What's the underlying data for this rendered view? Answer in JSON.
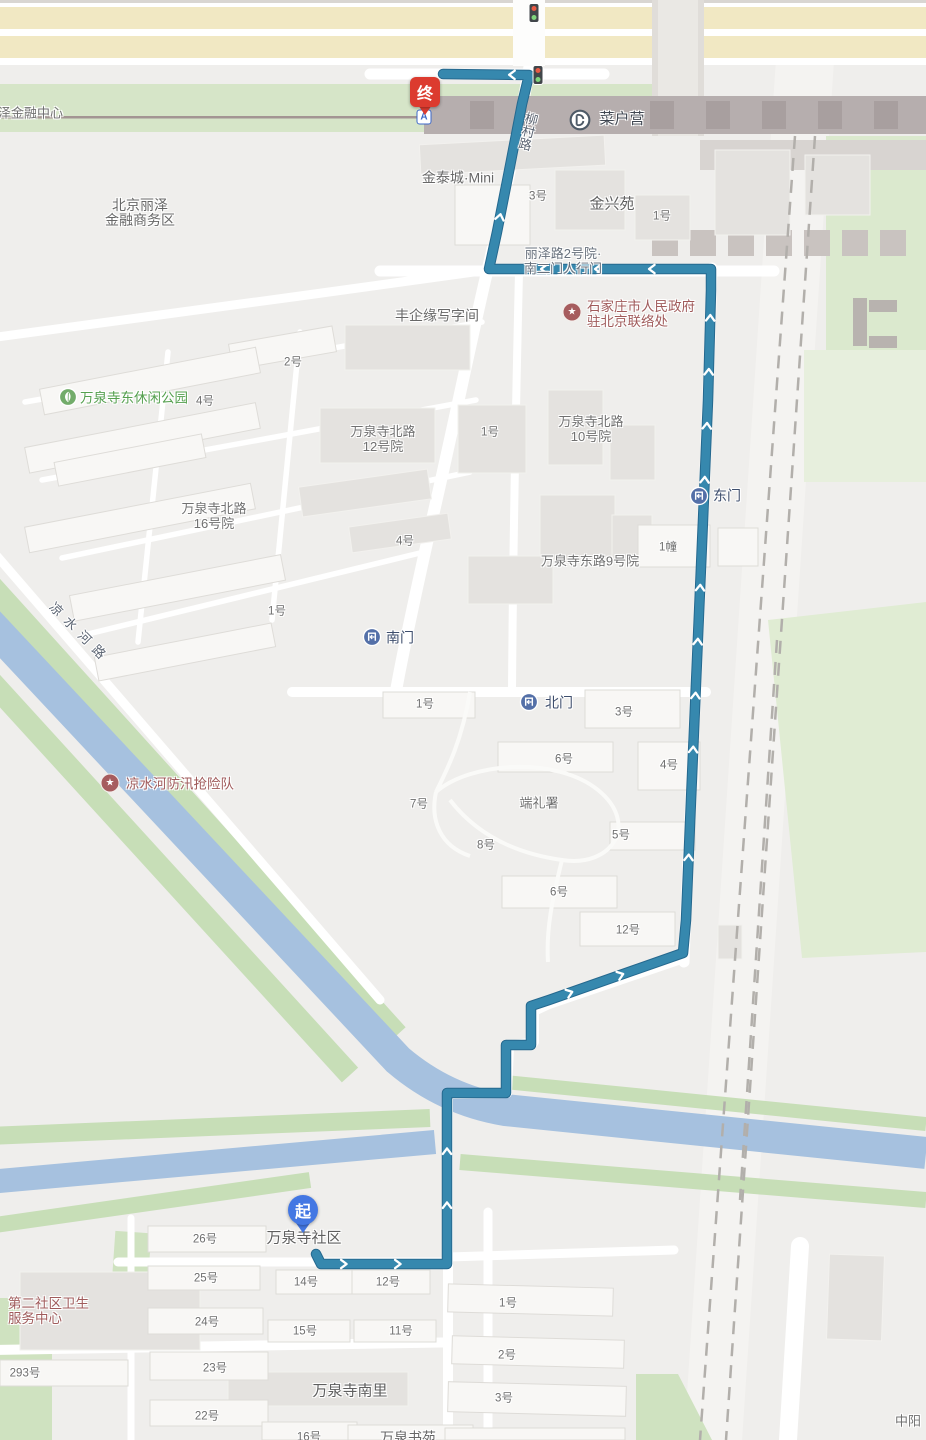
{
  "map": {
    "background": "#efeeec",
    "route": {
      "color": "#3688ae",
      "casing": "#25688e",
      "arrow_color": "#ffffff",
      "points": [
        [
          316,
          1254
        ],
        [
          321,
          1264
        ],
        [
          447,
          1264
        ],
        [
          447,
          1093
        ],
        [
          506,
          1093
        ],
        [
          506,
          1045
        ],
        [
          531,
          1045
        ],
        [
          531,
          1006
        ],
        [
          549,
          1000
        ],
        [
          683,
          953
        ],
        [
          686,
          920
        ],
        [
          691,
          800
        ],
        [
          697,
          660
        ],
        [
          703,
          520
        ],
        [
          708,
          400
        ],
        [
          711,
          290
        ],
        [
          711,
          269
        ],
        [
          489,
          269
        ],
        [
          497,
          232
        ],
        [
          510,
          166
        ],
        [
          522,
          104
        ],
        [
          529,
          75
        ],
        [
          443,
          74
        ]
      ]
    },
    "pins": {
      "end": {
        "label": "终",
        "color": "#dc3b2f",
        "x": 425,
        "y": 92
      },
      "start": {
        "label": "起",
        "color": "#4377e3",
        "x": 303,
        "y": 1210
      }
    },
    "icons": [
      {
        "type": "traffic-light",
        "x": 538,
        "y": 75
      },
      {
        "type": "traffic-light",
        "x": 534,
        "y": 13
      },
      {
        "type": "metro",
        "x": 580,
        "y": 120
      },
      {
        "type": "exit-a",
        "label": "A",
        "x": 424,
        "y": 117
      },
      {
        "type": "gate",
        "x": 699,
        "y": 496
      },
      {
        "type": "gate",
        "x": 372,
        "y": 637
      },
      {
        "type": "gate",
        "x": 529,
        "y": 702
      },
      {
        "type": "star",
        "x": 572,
        "y": 312
      },
      {
        "type": "star",
        "x": 110,
        "y": 783
      },
      {
        "type": "star",
        "x": -10,
        "y": 1305
      },
      {
        "type": "park",
        "x": 68,
        "y": 397
      }
    ],
    "labels": [
      {
        "t": "丽泽金融中心",
        "x": 24,
        "y": 113,
        "cls": "compound"
      },
      {
        "t": "北京丽泽\n金融商务区",
        "x": 140,
        "y": 213,
        "cls": "place-sm"
      },
      {
        "t": "金泰城·Mini",
        "x": 458,
        "y": 178,
        "cls": "place-sm"
      },
      {
        "t": "3号",
        "x": 538,
        "y": 197,
        "cls": "num"
      },
      {
        "t": "金兴苑",
        "x": 612,
        "y": 204,
        "cls": "place"
      },
      {
        "t": "1号",
        "x": 662,
        "y": 217,
        "cls": "num"
      },
      {
        "t": "丽泽路2号院·\n南二门人行门",
        "x": 563,
        "y": 261,
        "cls": "addr"
      },
      {
        "t": "石家庄市人民政府\n驻北京联络处",
        "x": 587,
        "y": 314,
        "cls": "poi-red",
        "align": "left"
      },
      {
        "t": "丰企缘写字间",
        "x": 437,
        "y": 316,
        "cls": "place-sm"
      },
      {
        "t": "2号",
        "x": 293,
        "y": 363,
        "cls": "num"
      },
      {
        "t": "万泉寺东休闲公园",
        "x": 134,
        "y": 398,
        "cls": "poi-green"
      },
      {
        "t": "4号",
        "x": 205,
        "y": 402,
        "cls": "num"
      },
      {
        "t": "万泉寺北路\n12号院",
        "x": 383,
        "y": 439,
        "cls": "compound"
      },
      {
        "t": "1号",
        "x": 490,
        "y": 433,
        "cls": "num"
      },
      {
        "t": "万泉寺北路\n10号院",
        "x": 591,
        "y": 429,
        "cls": "compound"
      },
      {
        "t": "万泉寺北路\n16号院",
        "x": 214,
        "y": 516,
        "cls": "compound"
      },
      {
        "t": "4号",
        "x": 405,
        "y": 542,
        "cls": "num"
      },
      {
        "t": "东门",
        "x": 727,
        "y": 496,
        "cls": "gate"
      },
      {
        "t": "万泉寺东路9号院",
        "x": 590,
        "y": 561,
        "cls": "compound"
      },
      {
        "t": "1幢",
        "x": 668,
        "y": 548,
        "cls": "num"
      },
      {
        "t": "南门",
        "x": 400,
        "y": 638,
        "cls": "gate"
      },
      {
        "t": "1号",
        "x": 277,
        "y": 612,
        "cls": "num"
      },
      {
        "t": "北门",
        "x": 559,
        "y": 703,
        "cls": "gate"
      },
      {
        "t": "1号",
        "x": 425,
        "y": 705,
        "cls": "num"
      },
      {
        "t": "3号",
        "x": 624,
        "y": 713,
        "cls": "num"
      },
      {
        "t": "6号",
        "x": 564,
        "y": 760,
        "cls": "num"
      },
      {
        "t": "4号",
        "x": 669,
        "y": 766,
        "cls": "num"
      },
      {
        "t": "凉水河防汛抢险队",
        "x": 180,
        "y": 784,
        "cls": "poi-red"
      },
      {
        "t": "7号",
        "x": 419,
        "y": 805,
        "cls": "num"
      },
      {
        "t": "端礼署",
        "x": 539,
        "y": 803,
        "cls": "compound"
      },
      {
        "t": "8号",
        "x": 486,
        "y": 846,
        "cls": "num"
      },
      {
        "t": "5号",
        "x": 621,
        "y": 836,
        "cls": "num"
      },
      {
        "t": "6号",
        "x": 559,
        "y": 893,
        "cls": "num"
      },
      {
        "t": "12号",
        "x": 628,
        "y": 931,
        "cls": "num"
      },
      {
        "t": "万泉寺社区",
        "x": 304,
        "y": 1238,
        "cls": "place"
      },
      {
        "t": "26号",
        "x": 205,
        "y": 1240,
        "cls": "num"
      },
      {
        "t": "25号",
        "x": 206,
        "y": 1279,
        "cls": "num"
      },
      {
        "t": "14号",
        "x": 306,
        "y": 1283,
        "cls": "num"
      },
      {
        "t": "12号",
        "x": 388,
        "y": 1283,
        "cls": "num"
      },
      {
        "t": "第二社区卫生\n服务中心",
        "x": 8,
        "y": 1311,
        "cls": "poi-red",
        "align": "left"
      },
      {
        "t": "24号",
        "x": 207,
        "y": 1323,
        "cls": "num"
      },
      {
        "t": "1号",
        "x": 508,
        "y": 1304,
        "cls": "num"
      },
      {
        "t": "15号",
        "x": 305,
        "y": 1332,
        "cls": "num"
      },
      {
        "t": "11号",
        "x": 401,
        "y": 1332,
        "cls": "num"
      },
      {
        "t": "293号",
        "x": 25,
        "y": 1374,
        "cls": "num"
      },
      {
        "t": "23号",
        "x": 215,
        "y": 1369,
        "cls": "num"
      },
      {
        "t": "2号",
        "x": 507,
        "y": 1356,
        "cls": "num"
      },
      {
        "t": "万泉寺南里",
        "x": 350,
        "y": 1391,
        "cls": "place"
      },
      {
        "t": "3号",
        "x": 504,
        "y": 1399,
        "cls": "num"
      },
      {
        "t": "22号",
        "x": 207,
        "y": 1417,
        "cls": "num"
      },
      {
        "t": "16号",
        "x": 309,
        "y": 1438,
        "cls": "num"
      },
      {
        "t": "万泉书苑",
        "x": 408,
        "y": 1438,
        "cls": "place-sm"
      },
      {
        "t": "中阳",
        "x": 908,
        "y": 1421,
        "cls": "compound"
      },
      {
        "t": "菜户营",
        "x": 622,
        "y": 119,
        "cls": "station"
      },
      {
        "t": "柳村路",
        "x": 527,
        "y": 131,
        "cls": "road",
        "rot": 14,
        "vert": true
      },
      {
        "t": "凉水河路",
        "x": 80,
        "y": 633,
        "cls": "road",
        "rot": 45,
        "ls": 7
      }
    ]
  }
}
